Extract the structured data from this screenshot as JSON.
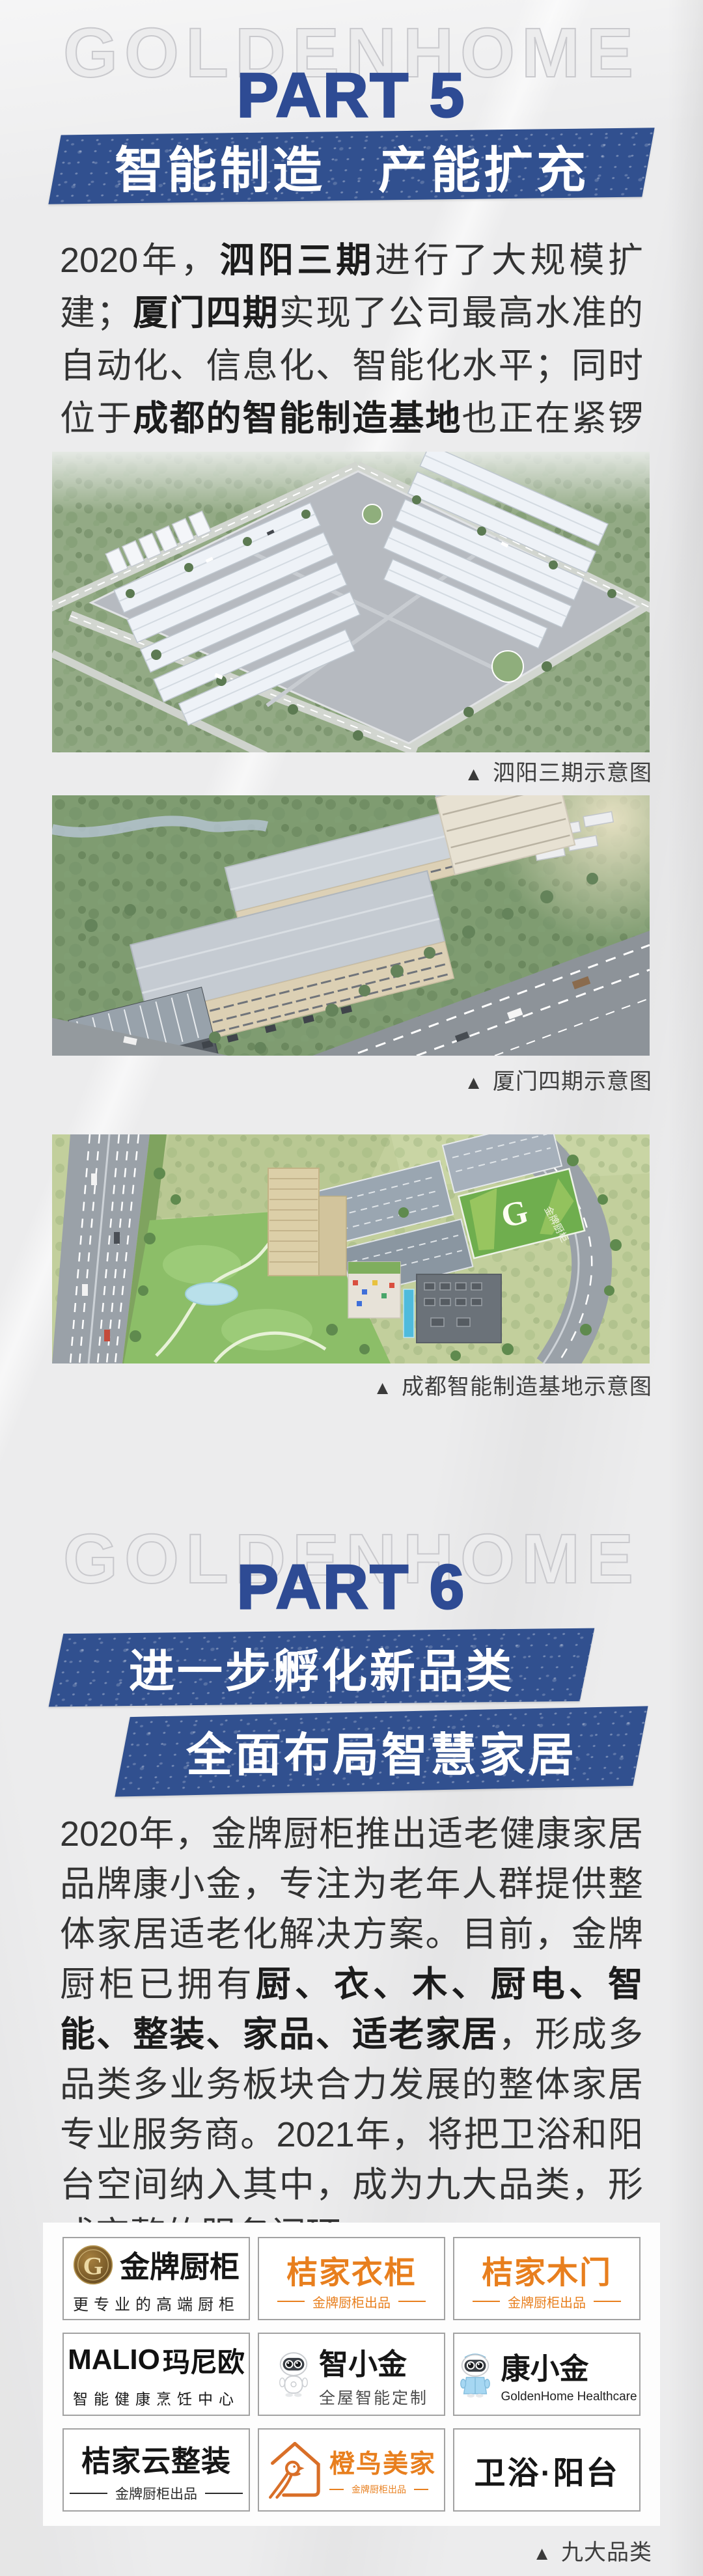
{
  "theme": {
    "accent_blue": "#2e4b94",
    "banner_blue": "#31508f",
    "orange": "#e87f1e",
    "body_text": "#333333",
    "caption_text": "#3e3e3e",
    "background": "#ececed"
  },
  "watermark": "GOLDENHOME",
  "part5": {
    "label": "PART 5",
    "banner": "智能制造　产能扩充",
    "paragraph_segments": [
      {
        "text": "2020年，",
        "bold": false
      },
      {
        "text": "泗阳三期",
        "bold": true
      },
      {
        "text": "进行了大规模扩建；",
        "bold": false
      },
      {
        "text": "厦门四期",
        "bold": true
      },
      {
        "text": "实现了公司最高水准的自动化、信息化、智能化水平；同时位于",
        "bold": false
      },
      {
        "text": "成都的智能制造基地",
        "bold": true
      },
      {
        "text": "也正在紧锣密鼓实施过程中。",
        "bold": false
      }
    ],
    "figures": [
      {
        "marker": "▲",
        "caption": "泗阳三期示意图"
      },
      {
        "marker": "▲",
        "caption": "厦门四期示意图"
      },
      {
        "marker": "▲",
        "caption": "成都智能制造基地示意图",
        "roof_sign_letter": "G",
        "roof_sign_text": "金牌厨柜"
      }
    ]
  },
  "part6": {
    "label": "PART 6",
    "banner_line1": "进一步孵化新品类",
    "banner_line2": "全面布局智慧家居",
    "paragraph_segments": [
      {
        "text": "2020年，金牌厨柜推出适老健康家居品牌康小金，专注为老年人群提供整体家居适老化解决方案。目前，金牌厨柜已拥有",
        "bold": false
      },
      {
        "text": "厨、衣、木、厨电、智能、整装、家品、适老家居",
        "bold": true
      },
      {
        "text": "，形成多品类多业务板块合力发展的整体家居专业服务商。2021年，将把卫浴和阳台空间纳入其中，成为九大品类，形成完整的服务闭环。",
        "bold": false
      }
    ],
    "grid_caption_marker": "▲",
    "grid_caption": "九大品类",
    "brands": [
      {
        "name": "金牌厨柜",
        "tagline": "更专业的高端厨柜",
        "logo_letter": "G"
      },
      {
        "name": "桔家衣柜",
        "tagline": "金牌厨柜出品"
      },
      {
        "name": "桔家木门",
        "tagline": "金牌厨柜出品"
      },
      {
        "name_en": "MALIO",
        "name": "玛尼欧",
        "tagline": "智能健康烹饪中心"
      },
      {
        "name": "智小金",
        "tagline": "全屋智能定制"
      },
      {
        "name": "康小金",
        "tagline": "GoldenHome Healthcare"
      },
      {
        "name": "桔家云整装",
        "tagline": "金牌厨柜出品"
      },
      {
        "name": "橙鸟美家",
        "tagline": "金牌厨柜出品"
      },
      {
        "name": "卫浴·阳台"
      }
    ]
  }
}
